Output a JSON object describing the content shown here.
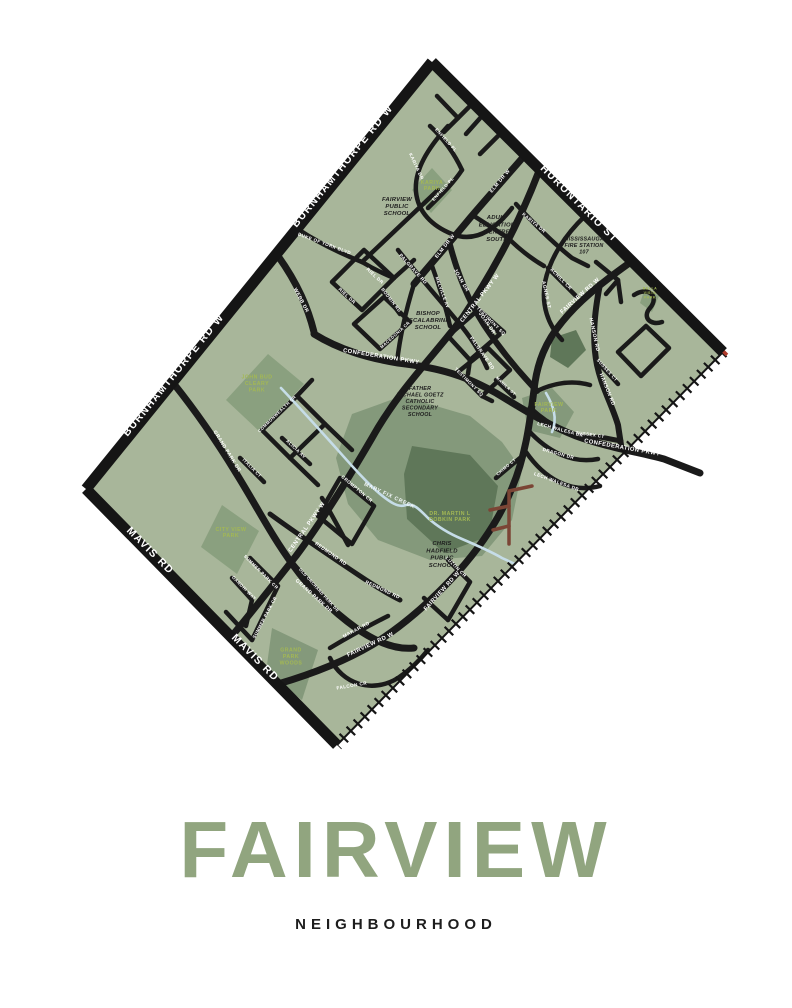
{
  "poster": {
    "title": "FAIRVIEW",
    "subtitle": "NEIGHBOURHOOD"
  },
  "colors": {
    "background": "#ffffff",
    "map_green": "#a8b69a",
    "park_green": "#8aa07f",
    "woods_green": "#84997b",
    "deep_woods_green": "#5f7759",
    "creek_blue": "#c6dde8",
    "road_black": "#1a1a1a",
    "border_black": "#151515",
    "trail_brown": "#7b4535",
    "park_label_green": "#a3b854",
    "title_green": "#91a57f",
    "subtitle_black": "#1d1d1d",
    "rail_accent_red": "#b13c2c"
  },
  "map": {
    "edge_labels": [
      {
        "t": "BURNHAMTHORPE RD W",
        "x": 176,
        "y": 377,
        "r": -51
      },
      {
        "t": "BURNHAMTHORPE RD W",
        "x": 345,
        "y": 168,
        "r": -51
      },
      {
        "t": "HURONTARIO ST",
        "x": 577,
        "y": 206,
        "r": 45
      },
      {
        "t": "MAVIS RD",
        "x": 148,
        "y": 553,
        "r": 45
      },
      {
        "t": "MAVIS RD",
        "x": 253,
        "y": 660,
        "r": 45
      }
    ],
    "street_labels": [
      {
        "t": "CENTRAL PKWY W",
        "x": 481,
        "y": 299,
        "r": -52
      },
      {
        "t": "CENTRAL PKWY W",
        "x": 308,
        "y": 528,
        "r": -55
      },
      {
        "t": "CONFEDERATION PKWY",
        "x": 381,
        "y": 358,
        "r": 9
      },
      {
        "t": "CONFEDERATION PKWY",
        "x": 622,
        "y": 449,
        "r": 10
      },
      {
        "t": "FAIRVIEW RD W",
        "x": 581,
        "y": 297,
        "r": -42
      },
      {
        "t": "FAIRVIEW RD W",
        "x": 443,
        "y": 592,
        "r": -48
      },
      {
        "t": "FAIRVIEW RD W",
        "x": 371,
        "y": 646,
        "r": -25
      },
      {
        "t": "WEBB DR",
        "x": 300,
        "y": 301,
        "r": 62,
        "s": 5
      },
      {
        "t": "DUKE OF YORK BLVD",
        "x": 324,
        "y": 245,
        "r": 20,
        "s": 4.6
      },
      {
        "t": "GRAND PARK DR",
        "x": 226,
        "y": 452,
        "r": 58,
        "s": 5
      },
      {
        "t": "GRAND PARK DR",
        "x": 313,
        "y": 597,
        "r": 42,
        "s": 5
      },
      {
        "t": "ELM DR W",
        "x": 501,
        "y": 182,
        "r": -50,
        "s": 5
      },
      {
        "t": "ELM DR W",
        "x": 446,
        "y": 247,
        "r": -52,
        "s": 5
      },
      {
        "t": "KARIYA DR",
        "x": 415,
        "y": 167,
        "r": 65,
        "s": 4.6
      },
      {
        "t": "KARIYA DR",
        "x": 533,
        "y": 224,
        "r": 40,
        "s": 4.6
      },
      {
        "t": "ENFIELD PL",
        "x": 445,
        "y": 141,
        "r": 48,
        "s": 4.4
      },
      {
        "t": "ENFIELD PL",
        "x": 444,
        "y": 190,
        "r": -48,
        "s": 4.4
      },
      {
        "t": "JOAN DR",
        "x": 460,
        "y": 281,
        "r": 60,
        "s": 5
      },
      {
        "t": "JOAN DR",
        "x": 486,
        "y": 324,
        "r": 55,
        "s": 5
      },
      {
        "t": "MELVILLE AV",
        "x": 441,
        "y": 293,
        "r": 70,
        "s": 4.4
      },
      {
        "t": "PALGRAVE RD",
        "x": 412,
        "y": 270,
        "r": 48,
        "s": 4.8
      },
      {
        "t": "PALGRAVE RD",
        "x": 481,
        "y": 354,
        "r": 55,
        "s": 4.8
      },
      {
        "t": "AGNES ST",
        "x": 545,
        "y": 295,
        "r": 78,
        "s": 4.8
      },
      {
        "t": "ACHILL CR",
        "x": 560,
        "y": 280,
        "r": 45,
        "s": 4.6
      },
      {
        "t": "HANSON RD",
        "x": 593,
        "y": 335,
        "r": 78,
        "s": 5
      },
      {
        "t": "HANSON RD",
        "x": 606,
        "y": 390,
        "r": 68,
        "s": 5
      },
      {
        "t": "TESTIMONY SQ",
        "x": 490,
        "y": 322,
        "r": 45,
        "s": 4.4
      },
      {
        "t": "TESTIMONY SQ",
        "x": 468,
        "y": 383,
        "r": 45,
        "s": 4.4
      },
      {
        "t": "MANILA ST",
        "x": 505,
        "y": 387,
        "r": 43,
        "s": 4
      },
      {
        "t": "SUSSEX CT",
        "x": 606,
        "y": 371,
        "r": 48,
        "s": 4.4
      },
      {
        "t": "SUSSEX CT",
        "x": 590,
        "y": 436,
        "r": 8,
        "s": 4.4
      },
      {
        "t": "LECH WALESA DR",
        "x": 560,
        "y": 431,
        "r": 15,
        "s": 4.6
      },
      {
        "t": "DRAGON DR",
        "x": 558,
        "y": 455,
        "r": 15,
        "s": 4.6
      },
      {
        "t": "LECH WALESA DR",
        "x": 556,
        "y": 483,
        "r": 20,
        "s": 4.6
      },
      {
        "t": "CHIMO CT",
        "x": 507,
        "y": 468,
        "r": -40,
        "s": 4.2
      },
      {
        "t": "RIEL DR",
        "x": 346,
        "y": 297,
        "r": 43,
        "s": 4.6
      },
      {
        "t": "RIEL DR",
        "x": 374,
        "y": 277,
        "r": 43,
        "s": 4.6
      },
      {
        "t": "MACEDONIA CR",
        "x": 396,
        "y": 336,
        "r": -42,
        "s": 4.2
      },
      {
        "t": "BODMIN RD",
        "x": 390,
        "y": 301,
        "r": 52,
        "s": 4.4
      },
      {
        "t": "COMMONWEALTH CR",
        "x": 278,
        "y": 415,
        "r": -44,
        "s": 4.2
      },
      {
        "t": "ALICIA AV",
        "x": 295,
        "y": 450,
        "r": 43,
        "s": 4.4
      },
      {
        "t": "ITALIA CT",
        "x": 251,
        "y": 469,
        "r": 45,
        "s": 4.4
      },
      {
        "t": "REDMOND RD",
        "x": 330,
        "y": 555,
        "r": 35,
        "s": 4.8
      },
      {
        "t": "REDMOND RD",
        "x": 382,
        "y": 591,
        "r": 25,
        "s": 4.8
      },
      {
        "t": "CROMPTON CR",
        "x": 356,
        "y": 490,
        "r": 40,
        "s": 4.6
      },
      {
        "t": "OLD ORCHARD PARK DR",
        "x": 318,
        "y": 591,
        "r": 48,
        "s": 4
      },
      {
        "t": "SUMMER PARK CR",
        "x": 260,
        "y": 573,
        "r": 45,
        "s": 4.4
      },
      {
        "t": "SUMMER PARK CR",
        "x": 266,
        "y": 618,
        "r": -62,
        "s": 4.4
      },
      {
        "t": "GANDHI WAY",
        "x": 243,
        "y": 589,
        "r": 45,
        "s": 4.4
      },
      {
        "t": "MAKAR RD",
        "x": 357,
        "y": 631,
        "r": -28,
        "s": 4.8
      },
      {
        "t": "FALCON CR",
        "x": 352,
        "y": 687,
        "r": -10,
        "s": 4.6
      },
      {
        "t": "LUZON CR",
        "x": 455,
        "y": 568,
        "r": 45,
        "s": 4.6
      }
    ],
    "park_labels": [
      {
        "lines": [
          "KARIYA",
          "PARK"
        ],
        "x": 432,
        "y": 187
      },
      {
        "lines": [
          "JOHN BUD",
          "CLEARY",
          "PARK"
        ],
        "x": 257,
        "y": 385
      },
      {
        "lines": [
          "CITY VIEW",
          "PARK"
        ],
        "x": 231,
        "y": 534
      },
      {
        "lines": [
          "GRAND",
          "PARK",
          "WOODS"
        ],
        "x": 291,
        "y": 658
      },
      {
        "lines": [
          "FAIRVIEW",
          "PARK"
        ],
        "x": 549,
        "y": 409
      },
      {
        "lines": [
          "DR. MARTIN L",
          "DOBKIN PARK"
        ],
        "x": 450,
        "y": 518
      },
      {
        "lines": [
          "BELLA",
          "VISTA",
          "PARK"
        ],
        "x": 650,
        "y": 294,
        "s": 3.6
      }
    ],
    "school_labels": [
      {
        "lines": [
          "FAIRVIEW",
          "PUBLIC",
          "SCHOOL"
        ],
        "x": 397,
        "y": 208
      },
      {
        "lines": [
          "ADULT",
          "EDUCATION",
          "CENTRE",
          "SOUTH"
        ],
        "x": 497,
        "y": 230
      },
      {
        "lines": [
          "MISSISSAUGA",
          "FIRE STATION",
          "107"
        ],
        "x": 584,
        "y": 247,
        "s": 5.4
      },
      {
        "lines": [
          "BISHOP",
          "SCALABRINI",
          "SCHOOL"
        ],
        "x": 428,
        "y": 322
      },
      {
        "lines": [
          "FATHER",
          "MICHAEL GOETZ",
          "CATHOLIC",
          "SECONDARY",
          "SCHOOL"
        ],
        "x": 420,
        "y": 403,
        "s": 5.4
      },
      {
        "lines": [
          "CHRIS",
          "HADFIELD",
          "PUBLIC",
          "SCHOOL"
        ],
        "x": 442,
        "y": 556
      }
    ],
    "water_labels": [
      {
        "t": "MARY FIX CREEK",
        "x": 389,
        "y": 497,
        "r": 25
      }
    ]
  }
}
